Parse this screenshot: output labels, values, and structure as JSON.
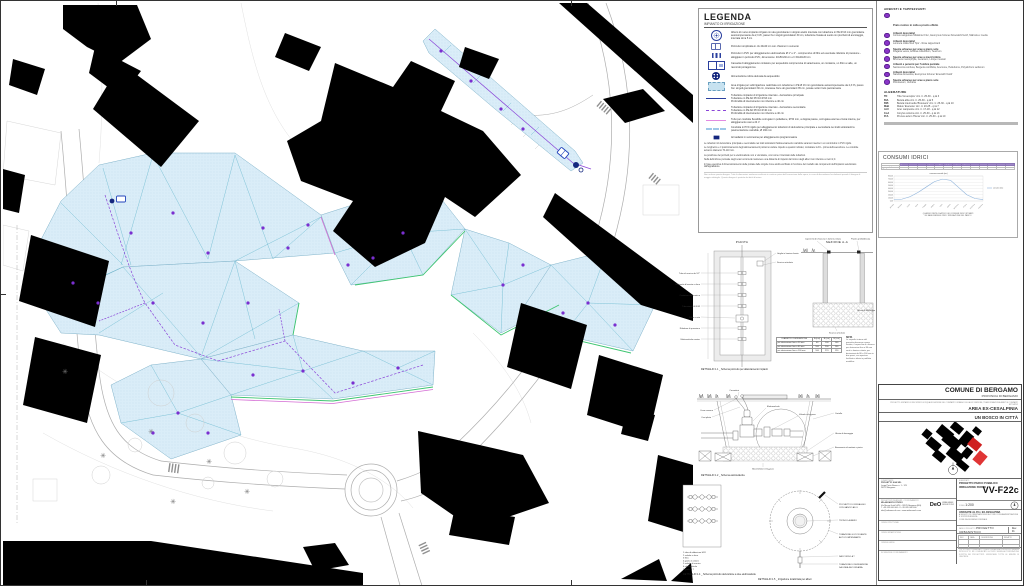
{
  "legend": {
    "title": "LEGENDA",
    "subtitle": "IMPIANTO DI IRRIGAZIONE",
    "items": [
      {
        "icon": "sprinkler-icon",
        "text": "Albero di nuovo impianto irrigato con ala gocciolante in doppio anello interrata con tubazione in PE Ø 16 mm gocciolante autocompensante da 2,3 l/h, passo fra i singoli gocciolatori 30 cm, tubazione fissata al suolo con picchetti di ancoraggio, interrata circa 5 cm"
      },
      {
        "icon": "pozzetto-icon",
        "text": "Pozzetto rompitratta in cls 40x40 cm con chiusino in cemento"
      },
      {
        "icon": "pozzetto-pvc-icon",
        "text": "Pozzetto in PVC per alloggiamento elettrovalvole Ø 1\" e 2\" - comprensivo di filtro ed eventuale riduttore di pressione - alloggiato in pozzetto PVC, dimensione: 40x50x30 cm e h 60x40x30 cm"
      },
      {
        "icon": "cassetta-icon",
        "text": "Cassetta di alloggiamento contatore per acquedotto comprensiva di saracinesca, un contatore, un filtro a valle, un raccordo portagomma"
      },
      {
        "icon": "presa-idrica-icon",
        "text": "Alimentazione idrica derivata da acquedotto"
      },
      {
        "icon": "area-irrigata-icon",
        "text": "Area irrigata per subirrigazione realizzata con tubazione in PE Ø 16 mm gocciolante autocompensante da 2,3 l/h, passo fra i singoli gocciolatori 30 cm, interasse fra le ali gocciolanti 35 cm, posate sotto il telo pacciamante"
      },
      {
        "icon": "linea-principale-icon",
        "text": "Tubazione impianto di irrigazione interrato - derivazione principale\nTubazione in PE AD PN 10 Ø 63 mm\nProfondità di interramento non inferiore a 40 cm"
      },
      {
        "icon": "linea-secondaria-icon",
        "text": "Tubazione impianto di irrigazione interrato - derivazione secondaria\nTubazione in PE AD PN 10 Ø 40 mm\nProfondità di interramento non inferiore a 40 cm"
      },
      {
        "icon": "linea-corrugato-icon",
        "text": "Tubo per condotte flessibile corrugato in polietilene, Ø 50 mm, a doppia parete, corrugata esterna e liscia interna, per alloggiamento cavi a 24 V"
      },
      {
        "icon": "linea-pvc-icon",
        "text": "Condotta in PVC rigido per alloggiamento tubazioni di derivazione principale e secondaria nei tratti sottostanti la pavimentazione carrabile, Ø 160 mm"
      },
      {
        "icon": "centralina-icon",
        "text": "Armadietto in vetroresina per alloggiamento programmatore"
      }
    ],
    "notes": [
      "Le tubazioni di derivazione principale e secondaria nei tratti sottostanti l'attraversamento carrabile saranno inserite in un controtubo in PVC rigido.",
      "Le lunghezze e il posizionamento degli attraversamenti potranno variare rispetto a quanto indicato; contattare la D.L. prima dell'esecuzione. Le condotte avranno diametro 70-110 mm.",
      "La posizione dei pozzetti per le elettrovalvole non è vincolante, così come il tracciato delle tubazioni.",
      "Nella definizione puntuale degli scavi occorrerà mantenere una distanza di rispetto dal tronco degli alberi non inferiore a metri 2,0.",
      "In fase esecutiva il dimensionamento delle portate delle singole zone andrà verificato in funzione del modello dei componenti dell'impianto selezionato dall'appaltatore."
    ],
    "footnote": "Non scalare questo disegno. Tutte le dimensioni andranno verificate in cantiere prima dell'esecuzione delle opere; in caso di discordanza fra elaborati prevale il disegno di maggior dettaglio. Questo disegno è protetto dai diritti d'autore."
  },
  "plants": {
    "header": "ARBUSTI E TAPPEZZANTI",
    "items": [
      {
        "label": "Prato rustico in zolla a pronto effetto",
        "species": ""
      },
      {
        "label": "Arbusti decorativi",
        "species": "Cornus sanguinea 'Midwinter Fire', Euonymus fortunei 'Emerald'n'Gold', Mahonia x media"
      },
      {
        "label": "Arbusti decorativi",
        "species": "Lonicera nitida 'Red Tips' - Rose tappezzanti"
      },
      {
        "label": "Specie erbacee per aree a pieno sole",
        "species": "Fragaria vesca, Achillea millefolium, Teucrium"
      },
      {
        "label": "Specie erbacee per aree a mezz'ombra",
        "species": "Brunnera macrophylla, Geranium, Liriope muscari"
      },
      {
        "label": "Arbusti e perenni per l'ombra parziale",
        "species": "Sarcococca confusa, Bergenia cordifolia, Anemone, Helleborus, Polystichum setiferum"
      },
      {
        "label": "Arbusti decorativi",
        "species": "Nandina domestica, Euonymus fortunei 'Emerald'n'Gold'"
      },
      {
        "label": "Specie erbacee per aree a pieno sole",
        "species": "Pennisetum, Verbena"
      }
    ]
  },
  "alberature": {
    "header": "ALBERATURE",
    "items": [
      {
        "code": "TD",
        "desc": "Tilia 'Greenspire' circ. tr. 25-30 - q.tà 3"
      },
      {
        "code": "BtA",
        "desc": "Betula alba circ. tr. 25-30 - q.tà 5"
      },
      {
        "code": "BtB",
        "desc": "Betula intermedia 'Brouwers' circ. tr. 25-30 - q.tà 10"
      },
      {
        "code": "MaE",
        "desc": "Malus 'Evereste' circ. tr. 20-25 - q.tà 7"
      },
      {
        "code": "AcC",
        "desc": "Acer campestre circ. tr. 17-18 - q.tà 12"
      },
      {
        "code": "CoA",
        "desc": "Corylus colurna circ. tr. 25-30 - q.tà 13"
      },
      {
        "code": "PrA",
        "desc": "Prunus avium 'Plena' circ. tr. 25-30 - q.tà 10"
      }
    ]
  },
  "consumi": {
    "title": "CONSUMI IDRICI",
    "caption1": "QUADRO RIEPILOGATIVO DEI CONSUMI IDRICI STIMATI",
    "caption2": "SU BASE MENSILE PER L'IRRIGAZIONE DEL PARCO",
    "table": {
      "months": [
        "gennaio",
        "febbraio",
        "marzo",
        "aprile",
        "maggio",
        "giugno",
        "luglio",
        "agosto",
        "settembre",
        "ottobre",
        "novembre",
        "dicembre"
      ],
      "total_label": "TOTALE",
      "rows": [
        {
          "label": "consumo (mc)",
          "values": [
            40,
            60,
            140,
            280,
            450,
            620,
            700,
            660,
            430,
            200,
            80,
            45
          ],
          "total": 3705
        },
        {
          "label": "gg irrigui",
          "values": [
            2,
            3,
            6,
            10,
            16,
            22,
            26,
            24,
            16,
            8,
            4,
            2
          ],
          "total": 139
        }
      ]
    }
  },
  "chart_data": {
    "type": "line",
    "title": "consumo mensile (mc)",
    "categories": [
      "gennaio",
      "febbraio",
      "marzo",
      "aprile",
      "maggio",
      "giugno",
      "luglio",
      "agosto",
      "settembre",
      "ottobre",
      "novembre",
      "dicembre"
    ],
    "series": [
      {
        "name": "consumo (mc)",
        "values": [
          40,
          60,
          140,
          280,
          450,
          620,
          700,
          660,
          430,
          200,
          80,
          45
        ]
      }
    ],
    "xlabel": "",
    "ylabel": "mc",
    "ylim": [
      0,
      800
    ],
    "grid": true,
    "legend_position": "right"
  },
  "details": {
    "d11": {
      "title": "PIANTA",
      "caption": "DETTAGLIO 1.1 _ Schema pozzetto per allacciamento impianti",
      "labels": [
        "Tubo di scarico da 1/2\"",
        "Rubinetto d'arresto a sfera",
        "Contatore volumetrico",
        "Tubazione DN 3/32",
        "Filtro a rete",
        "Riduttore di pressione",
        "Elettrovalvola master"
      ],
      "labels_r": [
        "Griglia in lamiera forata",
        "Scarico articolato"
      ]
    },
    "sezione": {
      "title": "SEZIONE A-A",
      "labels": [
        "Coperchio di chiusura in lamiera striata",
        "Piastra prefabbricata",
        "Ghiaia di drenaggio",
        "Scarico articolato"
      ]
    },
    "dtable": {
      "title": "DIAMETRO DERIVAZIONE",
      "cols": [
        "A (cm)",
        "B (cm)",
        "H (cm)"
      ],
      "rows": [
        [
          "per derivazione fino a 50 mm",
          "60",
          "100",
          "100"
        ],
        [
          "per derivazione fino a 80 mm",
          "100",
          "200",
          "100"
        ],
        [
          "per derivazione fino a 100 mm",
          "100",
          "270",
          "120"
        ]
      ]
    },
    "nota_title": "NOTA",
    "nota": "Le superfici interne del pozzetto dovranno essere lisciate; il coperchio di chiusura per derivazioni fino a 80 mm sarà in lamiera striata, per derivazioni da 80 a 100 mm in due pezzi, con apertura facilitata e telaio in profilato metallico.",
    "d12": {
      "caption": "DETTAGLIO 1.2 _ Schema elettrovalvola",
      "labels": [
        "Connettori",
        "Elettrovalvola",
        "Valvola in by-pass",
        "Cavo comune",
        "Cavi pilota",
        "Cartello",
        "Ghiaia di drenaggio",
        "Basamento di mattoni o pietra",
        "Bocchettone in by-pass"
      ]
    },
    "d14": {
      "caption": "DETTAGLIO 1.4 _ Schema pozzetto derivazione a due elettrovalvole",
      "parts": [
        "1 tubo di adduzione H2O",
        "2 valvola a sfera",
        "3 filtro",
        "4 giunto in ottone",
        "5 valvola di scarico",
        "6 elettrovalvola",
        "7 giunto a T"
      ]
    },
    "d15": {
      "caption": "DETTAGLIO 1.5 _ Irrigazione localizzata per alberi",
      "labels": [
        "PICCHETTO DI FISSAGGIO",
        "CON GANCIO AD U",
        "TRONCO ALBERO",
        "TUBAZIONE GOCCIOLANTE",
        "AUTOCOMPENSANTE",
        "RACCORDO A T",
        "TUBAZIONE DI DERIVAZIONE",
        "DA LINEA SECONDARIA"
      ]
    }
  },
  "titleblock": {
    "comune": "COMUNE DI BERGAMO",
    "provincia": "PROVINCIA DI BERGAMO",
    "area_note": "PROGETTO UNITARIO DI RECUPERO E RIQUALIFICAZIONE DEL COMPARTO URBANO DELLA EX STAZIONE, TRASFORMAZIONE AMBITI E COMPARTI ATTUATIVI",
    "area": "AREA EX-CESALPINIA",
    "progetto": "UN BOSCO IN CITTÀ",
    "committente_label": "COMMITTENTE",
    "committente": [
      "PROGETTO SUA SRL",
      "Largo Porta Nuova n. 1 - 123",
      "24122 Bergamo"
    ],
    "progettisti_label": "PROGETTISTI INCARICATI - COORDINAMENTO",
    "progettisti": [
      "MILANOARCH STUDIO",
      "Via Mauro Gatti 14/16 - 24125 Bergamo (BG)",
      "T +39 035 000 000 - F +39 035 000 000",
      "info@milanoarch.com - www.milanoarch.com"
    ],
    "logo": "DeO",
    "logo_sub1": "URBAN GREEN",
    "logo_sub2": "DESIGN STUDIO",
    "left_boxes": [
      "OPERE STRUTTURALI",
      "OPERE IMPIANTISTICHE",
      "OPERE A VERDE",
      "SICUREZZA E COORDINAMENTO"
    ],
    "elaborato_label": "ELABORATO",
    "doc_line1": "PROGETTO PARCO PUBBLICO",
    "doc_line2": "IRRIGAZIONE PARCO",
    "sheet_code": "VV-F22c",
    "scala_label": "SCALA",
    "scala": "1:200",
    "variante": "VARIANTE AL P.I.I. EX-CESALPINA",
    "variante_note1": "A SEGUITO DI OSSERVAZIONI ED ACCORDI CON AMMINISTRAZIONE E SOPRINTENDENZA",
    "variante_note2": "COME DA DELIBERA COMUNALE",
    "fase_label": "FASE DI PROGETTO",
    "fase": "PROGETTO URBANISTICO",
    "rev_label": "Rev.",
    "rev": "01",
    "rev_cols": [
      "REV",
      "DATA",
      "DESCRIZIONE",
      "REDATTO"
    ],
    "footer": "TUTTI I DIRITTI RISERVATI - QUESTO ELABORATO NON PUÒ ESSERE RIPRODOTTO NÉ COMUNICATO A TERZI SENZA AUTORIZZAZIONE SCRITTA DEI PROGETTISTI. VERIFICARE TUTTE LE MISURE IN CANTIERE."
  }
}
